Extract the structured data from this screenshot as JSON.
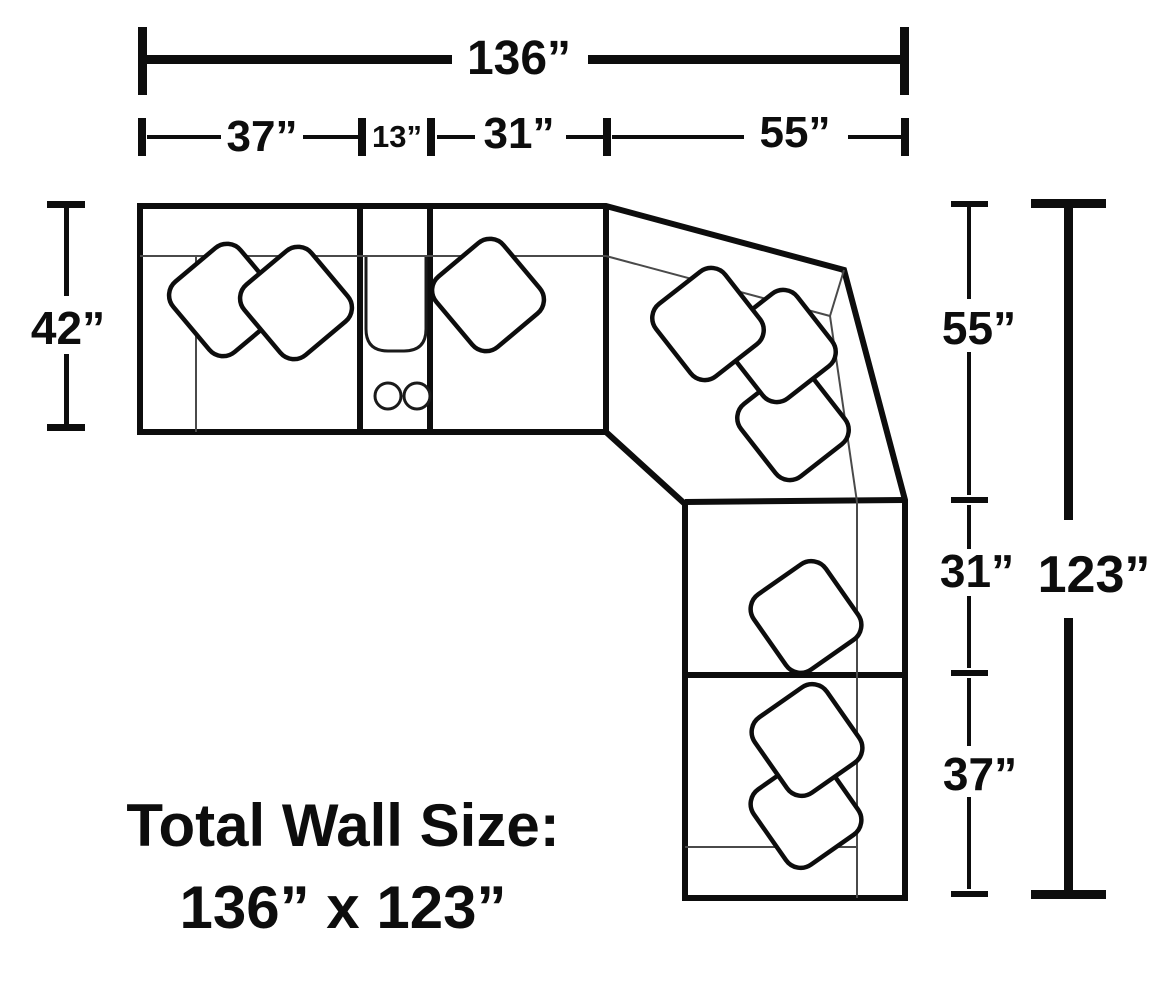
{
  "diagram": {
    "background_color": "#ffffff",
    "line_color": "#0d0d0d",
    "thin_line_color": "#4a4a4a",
    "dimensions": {
      "top_total": "136”",
      "top_segment_1": "37”",
      "top_segment_2": "13”",
      "top_segment_3": "31”",
      "top_segment_4": "55”",
      "left_depth": "42”",
      "right_segment_1": "55”",
      "right_segment_2": "31”",
      "right_segment_3": "37”",
      "right_total": "123”"
    },
    "caption": {
      "line1": "Total Wall Size:",
      "line2": "136” x 123”"
    }
  }
}
